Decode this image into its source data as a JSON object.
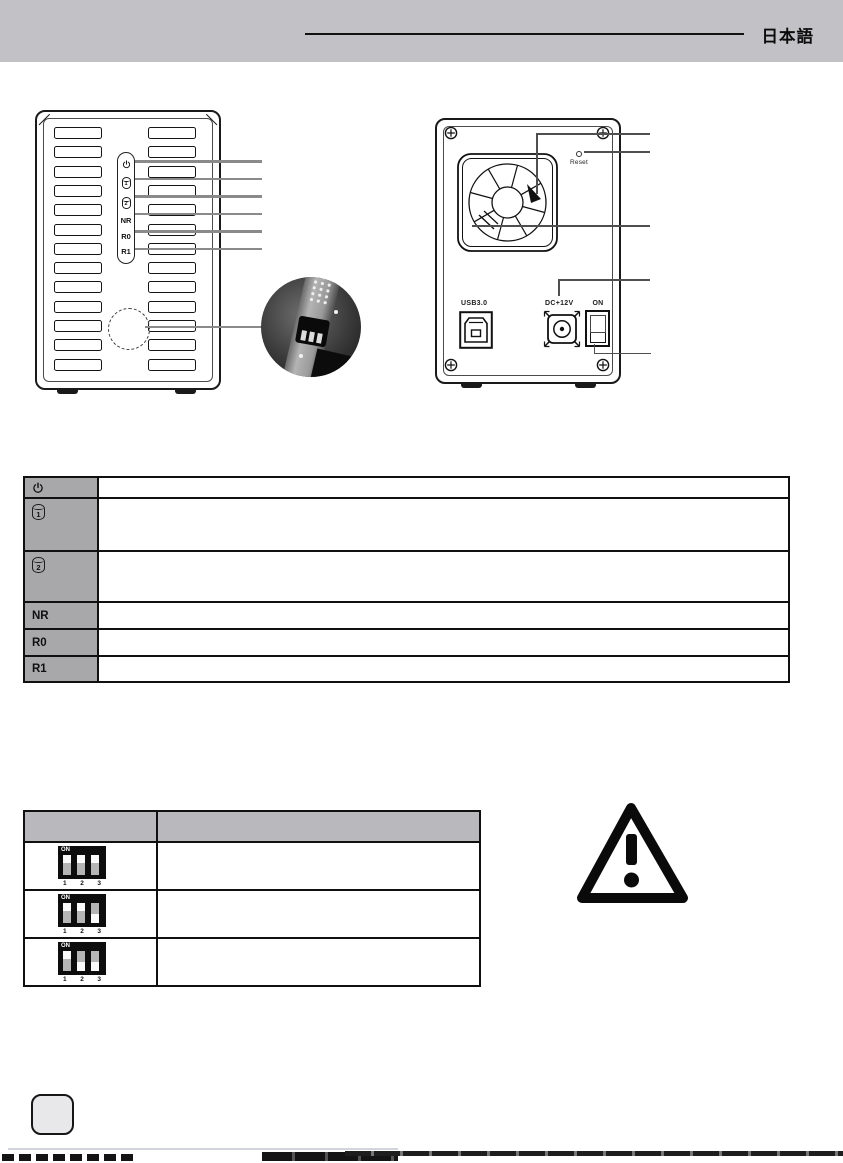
{
  "page": {
    "language_label": "日本語",
    "colors": {
      "header_band": "#c2c2c6",
      "led_table_label_gray": "#a8a8aa",
      "dip_table_header_gray": "#b9b9bd",
      "leader_line_gray": "#8a8a8a",
      "line_black": "#111111"
    }
  },
  "front_view": {
    "leds": [
      {
        "icon": "power-icon",
        "label": ""
      },
      {
        "icon": "hdd1-icon",
        "label": "1"
      },
      {
        "icon": "hdd2-icon",
        "label": "2"
      },
      {
        "icon": null,
        "label": "NR"
      },
      {
        "icon": null,
        "label": "R0"
      },
      {
        "icon": null,
        "label": "R1"
      }
    ]
  },
  "back_view": {
    "reset_label": "Reset",
    "usb_label": "USB3.0",
    "dc_label": "DC+12V",
    "power_switch_label": "ON"
  },
  "led_table": {
    "rows": [
      {
        "icon": "power-icon",
        "label": "",
        "description": ""
      },
      {
        "icon": "hdd1-icon",
        "label": "1",
        "description": ""
      },
      {
        "icon": "hdd2-icon",
        "label": "2",
        "description": ""
      },
      {
        "icon": null,
        "label": "NR",
        "description": ""
      },
      {
        "icon": null,
        "label": "R0",
        "description": ""
      },
      {
        "icon": null,
        "label": "R1",
        "description": ""
      }
    ]
  },
  "dip_table": {
    "header": [
      "",
      ""
    ],
    "on_label": "ON",
    "pin_labels": [
      "1",
      "2",
      "3"
    ],
    "rows": [
      {
        "switches": [
          "up",
          "up",
          "up"
        ],
        "description": ""
      },
      {
        "switches": [
          "up",
          "up",
          "down"
        ],
        "description": ""
      },
      {
        "switches": [
          "up",
          "down",
          "down"
        ],
        "description": ""
      }
    ]
  }
}
